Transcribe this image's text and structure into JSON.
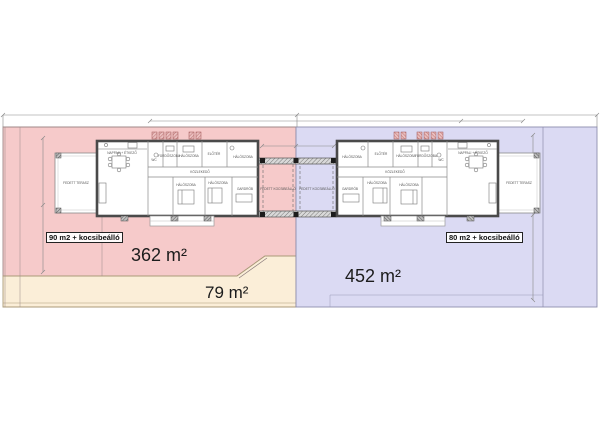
{
  "plots": {
    "left": {
      "badge": "90 m2 + kocsibeálló",
      "area": "362 m²",
      "fill": "#f6caca"
    },
    "left_front": {
      "area": "79 m²",
      "fill": "#fbeed8"
    },
    "right": {
      "badge": "80 m2 + kocsibeálló",
      "area": "452 m²",
      "fill": "#dbdaf3"
    }
  },
  "colors": {
    "wall": "#4a4a4a",
    "pink_border": "#a08888",
    "beige_border": "#ab9a78",
    "blue_border": "#8d8dad",
    "dimension_line": "#888888"
  },
  "rooms": [
    {
      "label": "NAPPALI + ÉTKEZŐ"
    },
    {
      "label": "WC"
    },
    {
      "label": "FÜRDŐSZOBA"
    },
    {
      "label": "HÁLÓSZOBA"
    },
    {
      "label": "ELŐTÉR"
    },
    {
      "label": "HÁLÓSZOBA"
    },
    {
      "label": "KÖZLEKEDŐ"
    },
    {
      "label": "HÁLÓSZOBA"
    },
    {
      "label": "HÁLÓSZOBA"
    },
    {
      "label": "GARDRÓB"
    },
    {
      "label": "FEDETT TERASZ"
    },
    {
      "label": "FEDETT KOCSIBEÁLLÓ"
    },
    {
      "label": "FEDETT KOCSIBEÁLLÓ"
    },
    {
      "label": "HÁLÓSZOBA"
    },
    {
      "label": "ELŐTÉR"
    },
    {
      "label": "HÁLÓSZOBA"
    },
    {
      "label": "FÜRDŐSZOBA"
    },
    {
      "label": "WC"
    },
    {
      "label": "NAPPALI + ÉTKEZŐ"
    },
    {
      "label": "KÖZLEKEDŐ"
    },
    {
      "label": "GARDRÓB"
    },
    {
      "label": "HÁLÓSZOBA"
    },
    {
      "label": "HÁLÓSZOBA"
    },
    {
      "label": "FEDETT TERASZ"
    }
  ]
}
